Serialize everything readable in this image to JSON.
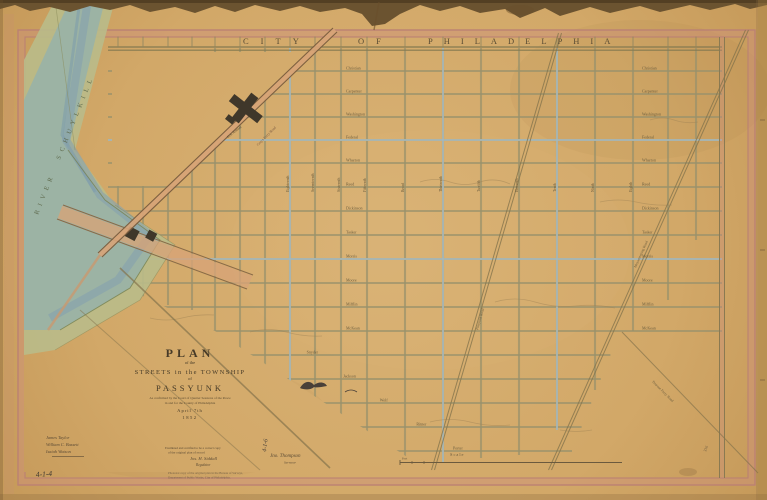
{
  "artifact": {
    "kind": "Scanned historic street plan of Passyunk township"
  },
  "colors": {
    "paper": "#d2a868",
    "border_pink": "#bb8173",
    "river_water": "#9cb3a4",
    "river_bank": "#b9bb8a",
    "street": "#99926c",
    "street_blue": "#a9bfc8",
    "ink": "#4a3b28",
    "building": "#3f372a",
    "road_fill": "#d8a478"
  },
  "top_band": {
    "words": [
      "CITY",
      "OF",
      "PHILADELPHIA"
    ]
  },
  "river": {
    "name_upper": "SCHUYLKILL",
    "name_lower": "RIVER"
  },
  "title_block": {
    "plan": "PLAN",
    "of_upper": "of the",
    "streets_line": "STREETS in the TOWNSHIP",
    "of_lower": "of",
    "township": "PASSYUNK",
    "confirm_line1": "As confirmed by the Court of Quarter Sessions of the Peace",
    "confirm_line2": "in and for the County of Philadelphia",
    "date_line": "April 7th",
    "year": "1852"
  },
  "signatures": {
    "names": [
      "James Taylor",
      "William C. Bassett",
      "Isaiah Watson"
    ],
    "cert_line1": "Examined and certified to be a correct copy",
    "cert_line2": "of the original plan of record",
    "cert_sig1": "Jos. H. Siddall",
    "cert_sig2": "Regulator",
    "attest_name": "Jno. Thompson",
    "attest_title": "Surveyor"
  },
  "scale_bar": {
    "label": "Scale",
    "unit": "Feet"
  },
  "marginalia": {
    "bottom_left_mark": "4-1-4",
    "pencil_mark": "4-1-6",
    "corner_mark": "316",
    "note_line1": "Photostat copy of the original plan in the Bureau of Surveys,",
    "note_line2": "Department of Public Works, City of Philadelphia."
  },
  "streets": {
    "horizontal": [
      "Christian",
      "Carpenter",
      "Washington",
      "Federal",
      "Wharton",
      "Reed",
      "Dickinson",
      "Tasker",
      "Morris",
      "Moore",
      "Mifflin",
      "McKean",
      "Snyder",
      "Jackson",
      "Wolf",
      "Ritner",
      "Porter"
    ],
    "vertical": [
      "Eighteenth",
      "Seventeenth",
      "Sixteenth",
      "Fifteenth",
      "Broad",
      "Thirteenth",
      "Twelfth",
      "Eleventh",
      "Tenth",
      "Ninth",
      "Eighth"
    ],
    "roads": {
      "d1": "Grays Ferry Road",
      "d5": "Passyunk Road",
      "d6": "Moyamensing Road",
      "d7": "Penrose Ferry Road"
    }
  },
  "landmarks": {
    "arsenal": "U.S. Arsenal"
  }
}
